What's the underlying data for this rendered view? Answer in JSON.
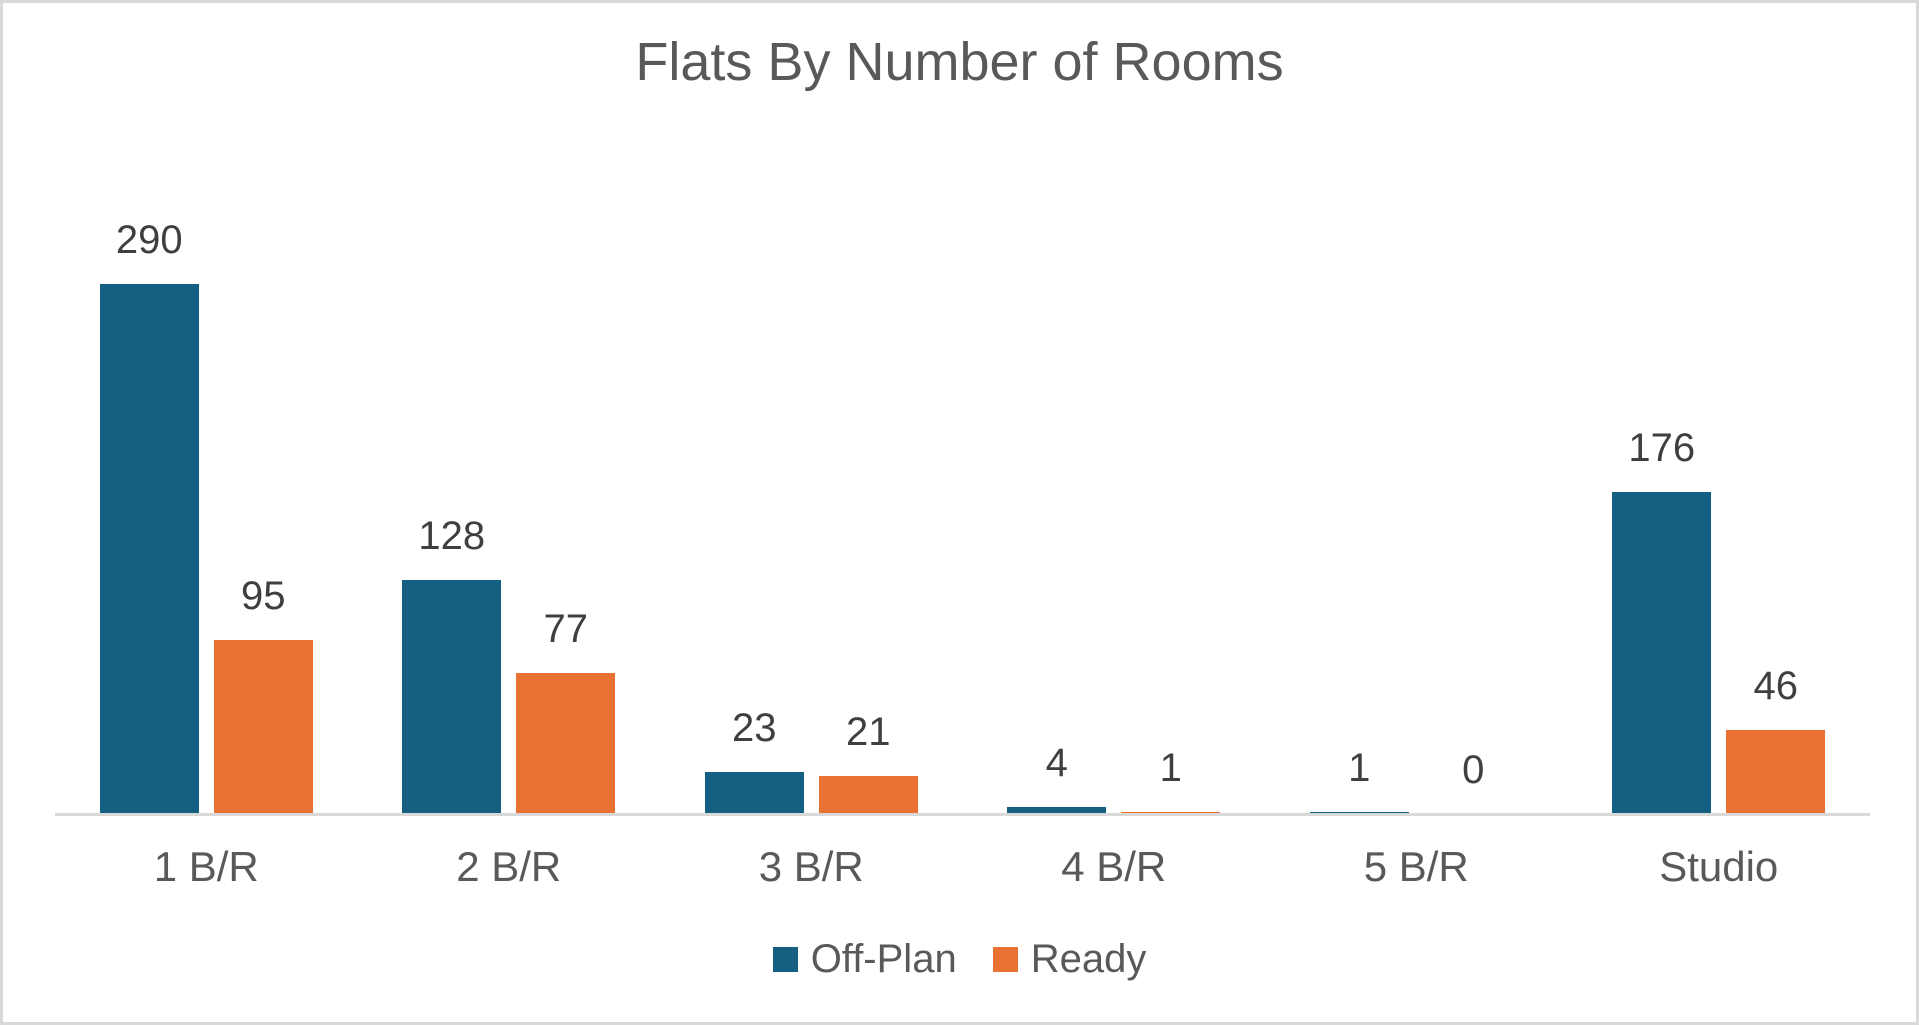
{
  "chart_data": {
    "type": "bar",
    "title": "Flats By Number of Rooms",
    "categories": [
      "1 B/R",
      "2 B/R",
      "3 B/R",
      "4 B/R",
      "5 B/R",
      "Studio"
    ],
    "series": [
      {
        "name": "Off-Plan",
        "color": "#156082",
        "values": [
          290,
          128,
          23,
          4,
          1,
          176
        ]
      },
      {
        "name": "Ready",
        "color": "#E97132",
        "values": [
          95,
          77,
          21,
          1,
          0,
          46
        ]
      }
    ],
    "data_labels_shown": true,
    "legend_position": "bottom",
    "gridlines": false,
    "y_axis_visible": false,
    "ylim": [
      0,
      300
    ],
    "axis_line_color": "#D9D9D9",
    "title_color": "#595959",
    "label_color": "#3F3F3F",
    "category_label_color": "#595959"
  }
}
